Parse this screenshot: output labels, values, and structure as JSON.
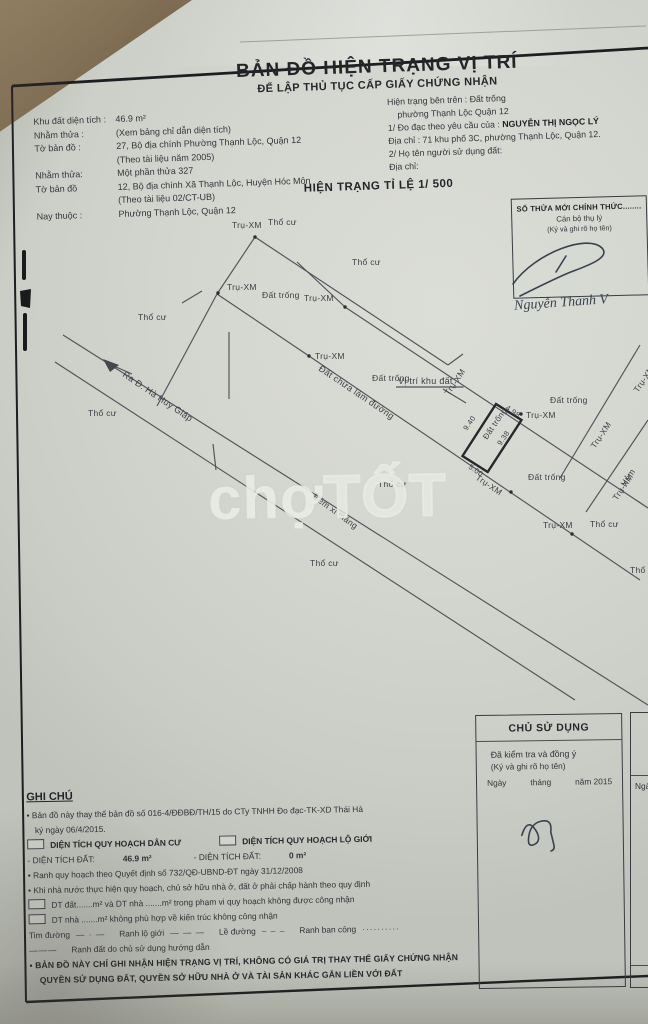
{
  "title": {
    "main": "BẢN ĐỒ HIỆN TRẠNG VỊ TRÍ",
    "sub": "ĐỂ LẬP THỦ TỤC CẤP GIẤY CHỨNG NHẬN"
  },
  "header_left": {
    "l1a": "Khu đất diện tích :",
    "l1b": "46.9 m²",
    "l2a": "Nhằm thửa :",
    "l2b": "(Xem bảng chỉ dẫn diện tích)",
    "l3a": "Tờ bản đồ :",
    "l3b": "27, Bộ địa chính Phường Thạnh Lộc, Quận 12",
    "l4": "(Theo tài liệu năm 2005)",
    "l5a": "Nhằm thửa:",
    "l5b": "Một phần thửa  327",
    "l6a": "Tờ bản đồ",
    "l6b": "12, Bộ địa chính Xã Thạnh Lộc, Huyện Hóc Môn",
    "l7": "(Theo tài liệu 02/CT-UB)",
    "l8a": "Nay thuộc :",
    "l8b": "Phường Thạnh Lộc, Quận 12"
  },
  "header_right": {
    "r1": "Hiện trạng bên trên : Đất trống",
    "r2": "phường Thạnh Lộc Quận 12",
    "r3a": "1/ Đo đạc theo yêu cầu của : ",
    "r3b": "NGUYỄN THỊ NGỌC LÝ",
    "r4": "Địa chỉ : 71 khu phố 3C, phường Thạnh Lộc, Quận 12.",
    "r5": "2/ Họ tên người sử dụng đất:",
    "r6": "Địa chỉ:"
  },
  "scale_heading": "HIỆN TRẠNG TỈ LỆ 1/ 500",
  "thua_box": {
    "line1": "SỐ THỬA MỚI CHÍNH THỨC........",
    "line2": "Cán bộ thụ lý",
    "line3": "(Ký và ghi rõ họ tên)",
    "signature": "Nguyễn Thanh V"
  },
  "watermark": {
    "part1": "chợ",
    "part2": "TỐT"
  },
  "map": {
    "lines": [
      [
        255,
        237,
        448,
        365
      ],
      [
        448,
        365,
        463,
        354
      ],
      [
        255,
        237,
        217,
        294
      ],
      [
        217,
        294,
        157,
        406
      ],
      [
        217,
        294,
        309,
        356
      ],
      [
        345,
        307,
        297,
        262
      ],
      [
        345,
        307,
        648,
        508
      ],
      [
        309,
        356,
        640,
        580
      ],
      [
        229,
        332,
        229,
        399
      ],
      [
        63,
        335,
        648,
        705
      ],
      [
        55,
        362,
        575,
        700
      ],
      [
        213,
        444,
        216,
        470
      ],
      [
        560,
        478,
        640,
        345
      ],
      [
        586,
        512,
        648,
        420
      ],
      [
        182,
        303,
        202,
        291
      ],
      [
        132,
        374,
        107,
        363
      ],
      [
        443,
        389,
        466,
        403
      ]
    ],
    "plot_points": "496,404 521.5,420 487.7,472 462.5,456",
    "arrow_points": "103,359 119,365 110,372",
    "dots": [
      [
        255,
        237
      ],
      [
        218,
        293
      ],
      [
        309,
        356
      ],
      [
        345,
        307
      ],
      [
        521,
        414
      ],
      [
        511,
        492
      ],
      [
        572,
        534
      ]
    ],
    "labels": [
      {
        "t": "Thổ cư",
        "x": 268,
        "y": 225
      },
      {
        "t": "Thổ cư",
        "x": 352,
        "y": 265
      },
      {
        "t": "Thổ cư",
        "x": 138,
        "y": 320
      },
      {
        "t": "Thổ cư",
        "x": 88,
        "y": 416
      },
      {
        "t": "Thổ cư",
        "x": 378,
        "y": 487
      },
      {
        "t": "Thổ cư",
        "x": 310,
        "y": 566
      },
      {
        "t": "Thổ cư",
        "x": 590,
        "y": 527
      },
      {
        "t": "Thổ cư",
        "x": 630,
        "y": 573
      },
      {
        "t": "Đất trống",
        "x": 262,
        "y": 298
      },
      {
        "t": "Đất trống",
        "x": 372,
        "y": 381
      },
      {
        "t": "Đất trống",
        "x": 550,
        "y": 403
      },
      {
        "t": "Đất trống",
        "x": 528,
        "y": 480
      },
      {
        "t": "Trụ-XM",
        "x": 232,
        "y": 228
      },
      {
        "t": "Trụ-XM",
        "x": 227,
        "y": 290
      },
      {
        "t": "Trụ-XM",
        "x": 315,
        "y": 359
      },
      {
        "t": "Trụ-XM",
        "x": 304,
        "y": 301
      },
      {
        "t": "Trụ-XM",
        "x": 526,
        "y": 418
      },
      {
        "t": "Trụ-XM",
        "x": 543,
        "y": 528
      },
      {
        "t": "Trụ-XM",
        "x": 449,
        "y": 396,
        "r": -56
      },
      {
        "t": "Trụ-XM",
        "x": 595,
        "y": 449,
        "r": -56
      },
      {
        "t": "Trụ-XM",
        "x": 617,
        "y": 501,
        "r": -56
      },
      {
        "t": "Trụ-XM",
        "x": 638,
        "y": 393,
        "r": -56
      },
      {
        "t": "Trụ-XM",
        "x": 475,
        "y": 479,
        "r": 34
      },
      {
        "t": "Đất trống",
        "x": 487,
        "y": 440,
        "r": -56,
        "s": 8
      },
      {
        "t": "9.40",
        "x": 467,
        "y": 431,
        "r": -56,
        "s": 7.5
      },
      {
        "t": "9.38",
        "x": 501,
        "y": 446,
        "r": -56,
        "s": 7.5
      },
      {
        "t": "5.00",
        "x": 468,
        "y": 468,
        "r": 34,
        "s": 7.5
      },
      {
        "t": "4.98",
        "x": 505,
        "y": 409,
        "r": 34,
        "s": 7.5
      },
      {
        "t": "Vị trí khu đất",
        "x": 398,
        "y": 384,
        "u": 1,
        "s": 9
      },
      {
        "t": "Đất chừa làm đường",
        "x": 318,
        "y": 370,
        "r": 34,
        "s": 9
      },
      {
        "t": "Ra Đ. Hà Huy Giáp",
        "x": 122,
        "y": 376,
        "r": 34,
        "s": 9
      },
      {
        "t": "Hẻm xi măng",
        "x": 312,
        "y": 498,
        "r": 36
      },
      {
        "t": "Hẻm",
        "x": 625,
        "y": 487,
        "r": -56
      }
    ]
  },
  "notes": {
    "heading": "GHI CHÚ",
    "n1": "• Bản đồ này thay thế bản đồ số 016-4/ĐĐBĐ/TH/15 do CTy TNHH Đo đạc-TK-XD Thái Hà",
    "n1b": "ký ngày 06/4/2015.",
    "q1": "DIỆN TÍCH QUY HOẠCH DÂN CƯ",
    "q2": "DIỆN TÍCH QUY HOẠCH LỘ GIỚI",
    "d1a": "- DIỆN TÍCH ĐẤT:",
    "d1b": "46.9 m²",
    "d2a": "- DIỆN TÍCH ĐẤT:",
    "d2b": "0 m²",
    "n2": "• Ranh quy hoạch theo Quyết định số 732/QĐ-UBND-ĐT ngày 31/12/2008",
    "n3": "• Khi nhà nước thực hiện quy hoạch, chủ sở hữu nhà ở, đất ở phải chấp hành theo quy định",
    "c1": "DT đất.......m²  và DT nhà .......m² trong phạm vi quy hoạch không được công nhận",
    "c2": "DT nhà .......m² không phù hợp về kiến trúc không công nhận",
    "leg1": "Tim đường",
    "leg1s": "— · —",
    "leg2": "Ranh lộ giới",
    "leg2s": "— — —",
    "leg3": "Lề đường",
    "leg3s": "– – –",
    "leg4": "Ranh ban công",
    "leg4s": "··········",
    "leg5s": "———",
    "leg5": "Ranh đất do chủ sử dụng hướng dẫn",
    "f_bullet": "▪",
    "f1": "BẢN ĐỒ NÀY CHỈ GHI NHẬN HIỆN TRẠNG VỊ TRÍ, KHÔNG CÓ GIÁ TRỊ THAY THẾ GIẤY CHỨNG NHẬN",
    "f2": "QUYỀN SỬ DỤNG ĐẤT, QUYỀN SỞ HỮU NHÀ Ở VÀ TÀI SẢN KHÁC GẮN LIỀN VỚI ĐẤT"
  },
  "owner_box": {
    "heading": "CHỦ SỬ DỤNG",
    "line1": "Đã kiểm tra và đồng ý",
    "line2": "(Ký và ghi rõ họ tên)",
    "d1": "Ngày",
    "d2": "tháng",
    "d3": "năm 2015",
    "partial": "Ngà"
  },
  "colors": {
    "paper": "#d3d6cf",
    "ink": "#33353b",
    "map_line": "#50535a",
    "frame": "#1d1e21",
    "wood": "#7b6950"
  }
}
